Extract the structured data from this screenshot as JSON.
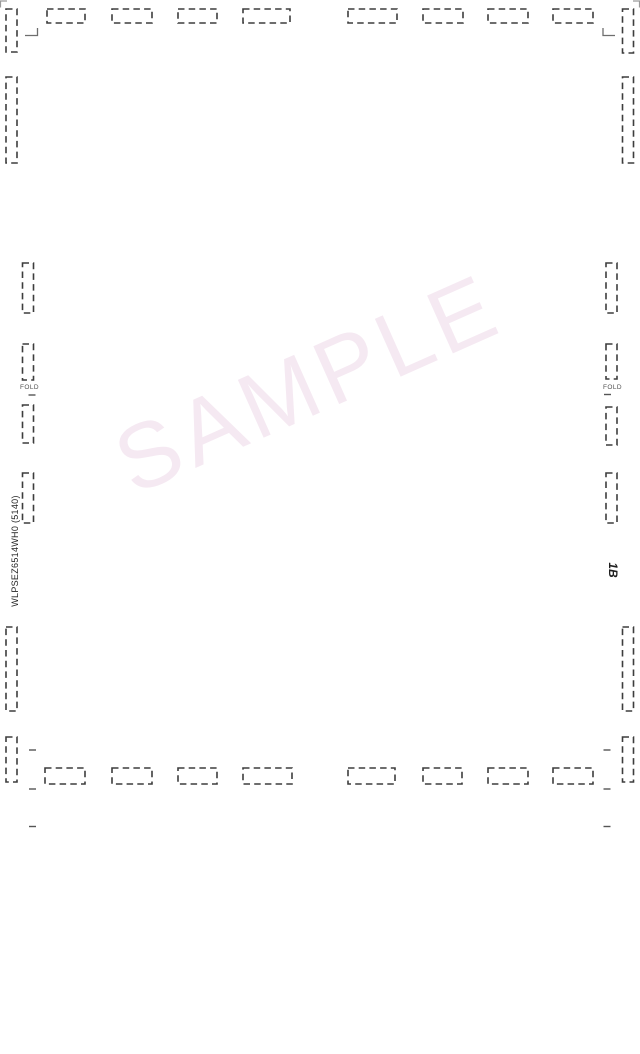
{
  "document": {
    "watermark": {
      "text": "SAMPLE",
      "color": "#f5e9f2",
      "rotation_deg": -24,
      "font_size_px": 92,
      "letter_spacing_px": 6,
      "center_x": 308,
      "center_y": 384
    },
    "part_number": "WLPSEZ6514WH0  (5140)",
    "sheet_code": "1B",
    "fold_labels": [
      {
        "side": "left",
        "text": "FOLD"
      },
      {
        "side": "right",
        "text": "FOLD"
      }
    ],
    "colors": {
      "dieline_mark": "#3d3d3d",
      "tick_mark": "#555555",
      "corner_mark": "#6e6e6e",
      "edge_mark": "#9a9a9a",
      "page_background": "#ffffff"
    }
  },
  "dieline_marks": {
    "dash_style": {
      "dash": 6.5,
      "gap": 4.2,
      "stroke_width": 1.6
    },
    "dash_rects": [
      {
        "x": 47,
        "y": 9,
        "w": 38,
        "h": 14
      },
      {
        "x": 112,
        "y": 9,
        "w": 40,
        "h": 14
      },
      {
        "x": 178,
        "y": 9,
        "w": 39,
        "h": 14
      },
      {
        "x": 243,
        "y": 9,
        "w": 47,
        "h": 14
      },
      {
        "x": 348,
        "y": 9,
        "w": 49,
        "h": 14
      },
      {
        "x": 423,
        "y": 9,
        "w": 40,
        "h": 14
      },
      {
        "x": 488,
        "y": 9,
        "w": 40,
        "h": 14
      },
      {
        "x": 553,
        "y": 9,
        "w": 40,
        "h": 14
      },
      {
        "x": 45,
        "y": 768,
        "w": 40,
        "h": 16
      },
      {
        "x": 112,
        "y": 768,
        "w": 40,
        "h": 16
      },
      {
        "x": 178,
        "y": 768,
        "w": 39,
        "h": 16
      },
      {
        "x": 243,
        "y": 768,
        "w": 49,
        "h": 16
      },
      {
        "x": 348,
        "y": 768,
        "w": 47,
        "h": 16
      },
      {
        "x": 423,
        "y": 768,
        "w": 39,
        "h": 16
      },
      {
        "x": 488,
        "y": 768,
        "w": 40,
        "h": 16
      },
      {
        "x": 553,
        "y": 768,
        "w": 40,
        "h": 16
      },
      {
        "x": 6,
        "y": 9,
        "w": 11,
        "h": 43
      },
      {
        "x": 6,
        "y": 77,
        "w": 11,
        "h": 86
      },
      {
        "x": 6,
        "y": 627,
        "w": 11,
        "h": 84
      },
      {
        "x": 6,
        "y": 737,
        "w": 11,
        "h": 45
      },
      {
        "x": 22.5,
        "y": 263,
        "w": 11,
        "h": 50
      },
      {
        "x": 22.5,
        "y": 344,
        "w": 11,
        "h": 36
      },
      {
        "x": 22.5,
        "y": 405,
        "w": 11,
        "h": 38
      },
      {
        "x": 22.5,
        "y": 473,
        "w": 11,
        "h": 50
      },
      {
        "x": 606,
        "y": 263,
        "w": 11,
        "h": 50
      },
      {
        "x": 606,
        "y": 344,
        "w": 11,
        "h": 35
      },
      {
        "x": 606,
        "y": 407,
        "w": 11,
        "h": 38
      },
      {
        "x": 606,
        "y": 473,
        "w": 11,
        "h": 50
      },
      {
        "x": 622.5,
        "y": 9,
        "w": 11,
        "h": 44
      },
      {
        "x": 622.5,
        "y": 77,
        "w": 11,
        "h": 86
      },
      {
        "x": 622.5,
        "y": 627,
        "w": 11,
        "h": 84
      },
      {
        "x": 622.5,
        "y": 737,
        "w": 11,
        "h": 45
      }
    ],
    "ticks": [
      {
        "x": 29,
        "y": 750,
        "w": 7
      },
      {
        "x": 29,
        "y": 789,
        "w": 7
      },
      {
        "x": 29,
        "y": 826.5,
        "w": 7
      },
      {
        "x": 603.5,
        "y": 750,
        "w": 7
      },
      {
        "x": 603.5,
        "y": 789,
        "w": 7
      },
      {
        "x": 603.5,
        "y": 826.5,
        "w": 7
      },
      {
        "x": 28.5,
        "y": 395,
        "w": 7
      },
      {
        "x": 604,
        "y": 394.5,
        "w": 7
      }
    ],
    "corner_marks": [
      {
        "points": [
          [
            25,
            35.5
          ],
          [
            37.5,
            35.5
          ],
          [
            37.5,
            28
          ]
        ]
      },
      {
        "points": [
          [
            615,
            35.5
          ],
          [
            603,
            35.5
          ],
          [
            603,
            28
          ]
        ]
      }
    ],
    "edge_marks": [
      {
        "points": [
          [
            7,
            1
          ],
          [
            0.5,
            1
          ],
          [
            0.5,
            7.5
          ]
        ]
      },
      {
        "points": [
          [
            633,
            1
          ],
          [
            639.5,
            1
          ],
          [
            639.5,
            7.5
          ]
        ]
      }
    ]
  }
}
